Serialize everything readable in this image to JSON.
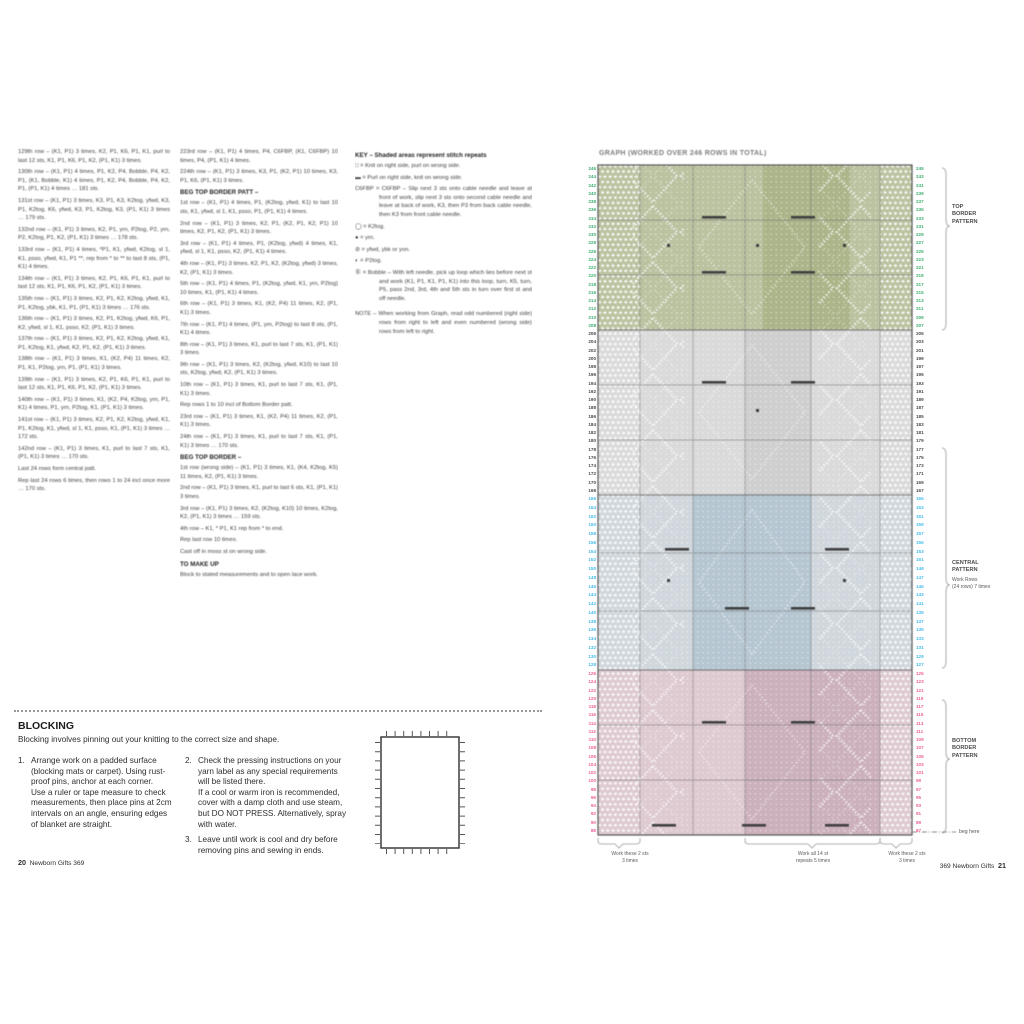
{
  "page_left": {
    "column1": [
      "129th row – (K1, P1) 3 times, K2, P1, K6, P1, K1, purl to last 12 sts, K1, P1, K6, P1, K2, (P1, K1) 3 times.",
      "130th row – (K1, P1) 4 times, P1, K2, P4, Bobble, P4, K2, P1, (K1, Bobble, K1) 4 times, P1, K2, P4, Bobble, P4, K2, P1, (P1, K1) 4 times … 181 sts.",
      "131st row – (K1, P1) 3 times, K3, P1, K3, K2tog, yfwd, K3, P1, K2tog, K6, yfwd, K3, P1, K2tog, K3, (P1, K1) 3 times … 179 sts.",
      "132nd row – (K1, P1) 3 times, K2, P1, yrn, P2tog, P2, yrn, P2, K2tog, P1, K2, (P1, K1) 3 times … 178 sts.",
      "133rd row – (K1, P1) 4 times, *P1, K1, yfwd, K2tog, sl 1, K1, psso, yfwd, K1, P1 **, rep from * to ** to last 8 sts, (P1, K1) 4 times.",
      "134th row – (K1, P1) 3 times, K2, P1, K6, P1, K1, purl to last 12 sts, K1, P1, K6, P1, K2, (P1, K1) 3 times.",
      "135th row – (K1, P1) 3 times, K2, P1, K2, K2tog, yfwd, K1, P1, K2tog, ybk, K1, P1, (P1, K1) 3 times … 176 sts.",
      "136th row – (K1, P1) 3 times, K2, P1, K2tog, yfwd, K6, P1, K2, yfwd, sl 1, K1, psso, K2, (P1, K1) 3 times.",
      "137th row – (K1, P1) 3 times, K2, P1, K2, K2tog, yfwd, K1, P1, K2tog, K1, yfwd, K2, P1, K2, (P1, K1) 3 times.",
      "138th row – (K1, P1) 3 times, K1, (K2, P4) 11 times, K2, P1, K1, P2tog, yrn, P1, (P1, K1) 3 times.",
      "139th row – (K1, P1) 3 times, K2, P1, K6, P1, K1, purl to last 12 sts, K1, P1, K6, P1, K2, (P1, K1) 3 times.",
      "140th row – (K1, P1) 3 times, K1, (K2, P4, K2tog, yrn, P1, K1) 4 times, P1, yrn, P2tog, K1, (P1, K1) 3 times.",
      "141st row – (K1, P1) 3 times, K2, P1, K2, K2tog, yfwd, K1, P1, K2tog, K1, yfwd, sl 1, K1, psso, K1, (P1, K1) 3 times … 172 sts.",
      "142nd row – (K1, P1) 3 times, K1, purl to last 7 sts, K1, (P1, K1) 3 times … 170 sts.",
      "Last 24 rows form central patt.",
      "Rep last 24 rows 6 times, then rows 1 to 24 incl once more … 170 sts."
    ],
    "column2_pre": [
      "223rd row – (K1, P1) 4 times, P4, C6FBP, (K1, C6FBP) 10 times, P4, (P1, K1) 4 times.",
      "224th row – (K1, P1) 3 times, K3, P1, (K2, P1) 10 times, K3, P1, K6, (P1, K1) 3 times."
    ],
    "column2_heading1": "BEG TOP BORDER PATT –",
    "column2_rows1": [
      "1st row – (K1, P1) 4 times, P1, (K2tog, yfwd, K1) to last 10 sts, K1, yfwd, sl 1, K1, psso, P1, (P1, K1) 4 times.",
      "2nd row – (K1, P1) 3 times, K2, P1, (K2, P1, K2, P1) 10 times, K2, P1, K2, (P1, K1) 3 times.",
      "3rd row – (K1, P1) 4 times, P1, (K2tog, yfwd) 4 times, K1, yfwd, sl 1, K1, psso, K2, (P1, K1) 4 times.",
      "4th row – (K1, P1) 3 times, K2, P1, K2, (K2tog, yfwd) 3 times, K2, (P1, K1) 3 times.",
      "5th row – (K1, P1) 4 times, P1, (K2tog, yfwd, K1, yrn, P2tog) 10 times, K1, (P1, K1) 4 times.",
      "6th row – (K1, P1) 3 times, K1, (K2, P4) 11 times, K2, (P1, K1) 3 times.",
      "7th row – (K1, P1) 4 times, (P1, yrn, P2tog) to last 8 sts, (P1, K1) 4 times.",
      "8th row – (K1, P1) 3 times, K1, purl to last 7 sts, K1, (P1, K1) 3 times.",
      "9th row – (K1, P1) 3 times, K2, (K2tog, yfwd, K10) to last 10 sts, K2tog, yfwd, K2, (P1, K1) 3 times.",
      "10th row – (K1, P1) 3 times, K1, purl to last 7 sts, K1, (P1, K1) 3 times.",
      "Rep rows 1 to 10 incl of Bottom Border patt.",
      "23rd row – (K1, P1) 3 times, K1, (K2, P4) 11 times, K2, (P1, K1) 3 times.",
      "24th row – (K1, P1) 3 times, K1, purl to last 7 sts, K1, (P1, K1) 3 times … 170 sts."
    ],
    "column2_heading2": "BEG TOP BORDER –",
    "column2_rows2": [
      "1st row (wrong side) – (K1, P1) 3 times, K1, (K4, K2tog, K5) 11 times, K2, (P1, K1) 3 times.",
      "2nd row – (K1, P1) 3 times, K1, purl to last 6 sts, K1, (P1, K1) 3 times.",
      "3rd row – (K1, P1) 3 times, K2, (K2tog, K10) 10 times, K2tog, K2, (P1, K1) 3 times … 159 sts.",
      "4th row – K1, * P1, K1 rep from * to end.",
      "Rep last row 10 times.",
      "Cast off in moss st on wrong side."
    ],
    "column2_heading3": "TO MAKE UP",
    "column2_makeup": "Block to stated measurements and to open lace work.",
    "key": {
      "heading": "KEY –  Shaded areas represent stitch repeats",
      "items": [
        "□ = Knit on right side, purl on wrong side.",
        "▬ = Purl on right side, knit on wrong side.",
        "C6FBP = C6FBP – Slip next 3 sts onto cable needle and leave at front of work, slip next 3 sts onto second cable needle and leave at back of work, K3, then P3 from back cable needle, then K3 from front cable needle.",
        "◯ = K2tog.",
        "● = yrn.",
        "⊘ = yfwd, ybk or yon.",
        "◐ = P2tog.",
        "Ⓑ = Bobble – With left needle, pick up loop which lies before next st and work (K1, P1, K1, P1, K1) into this loop, turn, K5, turn, P5, pass 2nd, 3rd, 4th and 5th sts in turn over first st and off needle."
      ],
      "note": "NOTE – When working from Graph, read odd numbered (right side) rows from right to left and even numbered (wrong side) rows from left to right."
    },
    "blocking": {
      "heading": "BLOCKING",
      "intro": "Blocking involves pinning out your knitting to the correct size and shape.",
      "steps": [
        {
          "num": "1.",
          "text": [
            "Arrange work on a padded surface (blocking mats or carpet). Using rust-proof pins, anchor at each corner.",
            "Use a ruler or tape measure to check measurements, then place pins at 2cm intervals on an angle, ensuring edges of blanket are straight."
          ]
        },
        {
          "num": "2.",
          "text": [
            "Check the pressing instructions on your yarn label as any special requirements will be listed there.",
            "If a cool or warm iron is recommended, cover with a damp cloth and use steam, but DO NOT PRESS. Alternatively, spray with water."
          ]
        },
        {
          "num": "3.",
          "text": [
            "Leave until work is cool and dry before removing pins and sewing in ends."
          ]
        }
      ]
    },
    "footer": {
      "page": "20",
      "title": "Newborn Gifts 369"
    }
  },
  "page_right": {
    "chart_title": "GRAPH (WORKED OVER 246 ROWS IN TOTAL)",
    "side_labels": {
      "top": [
        "TOP",
        "BORDER",
        "PATTERN"
      ],
      "central_title": [
        "CENTRAL",
        "PATTERN"
      ],
      "central_sub": [
        "Work Rows",
        "(24 rows) 7 times"
      ],
      "bottom": [
        "BOTTOM",
        "BORDER",
        "PATTERN"
      ],
      "beg_here": "beg here"
    },
    "bottom_labels": {
      "left": [
        "Work these 2 sts",
        "3 times"
      ],
      "center": [
        "Work all 14 st",
        "repeats 5 times"
      ],
      "right": [
        "Work these 2 sts",
        "3 times"
      ]
    },
    "row_numbers": {
      "left_green": [
        246,
        244,
        242,
        240,
        238,
        236,
        234,
        232,
        230,
        228,
        226,
        224,
        222,
        220,
        218,
        216,
        214,
        212,
        210,
        208
      ],
      "left_gray": [
        206,
        204,
        202,
        200,
        198,
        196,
        194,
        192,
        190,
        188,
        186,
        184,
        182,
        180,
        178,
        176,
        174,
        172,
        170,
        168
      ],
      "left_blue": [
        166,
        164,
        162,
        160,
        158,
        156,
        154,
        152,
        150,
        148,
        146,
        144,
        142,
        140,
        138,
        136,
        134,
        132,
        130,
        128
      ],
      "left_pink": [
        126,
        124,
        122,
        120,
        118,
        116,
        114,
        112,
        110,
        108,
        106,
        104,
        102,
        100,
        98,
        96,
        94,
        92,
        90,
        88
      ],
      "right_green": [
        245,
        243,
        241,
        239,
        237,
        235,
        233,
        231,
        229,
        227,
        225,
        223,
        221,
        219,
        217,
        215,
        213,
        211,
        209,
        207
      ],
      "right_gray": [
        205,
        203,
        201,
        199,
        197,
        195,
        193,
        191,
        189,
        187,
        185,
        183,
        181,
        179,
        177,
        175,
        173,
        171,
        169,
        167
      ],
      "right_blue": [
        165,
        163,
        161,
        159,
        157,
        155,
        153,
        151,
        149,
        147,
        145,
        143,
        141,
        139,
        137,
        135,
        133,
        131,
        129,
        127
      ],
      "right_pink": [
        125,
        123,
        121,
        119,
        117,
        115,
        113,
        111,
        109,
        107,
        105,
        103,
        101,
        99,
        97,
        95,
        93,
        91,
        89,
        87
      ]
    },
    "footer": {
      "title": "369 Newborn Gifts",
      "page": "21"
    }
  },
  "chart": {
    "colors": {
      "top_band": "#b7bf9b",
      "top_band_dark": "#a7b183",
      "mid_band": "#d8d8d8",
      "mid_band_dark": "#cccccc",
      "central_band": "#cdd5db",
      "central_band_dark": "#b2c3cf",
      "bottom_band": "#dcc7ce",
      "bottom_band_dark": "#c9acb9",
      "marker_green": "#3fae74",
      "marker_gray": "#4a4a4a",
      "marker_cyan": "#45bcec",
      "marker_pink": "#f0609b"
    }
  }
}
